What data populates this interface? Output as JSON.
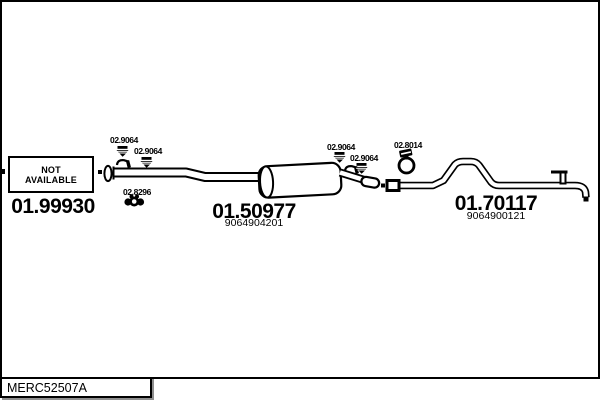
{
  "footer": {
    "reference_code": "MERC52507A"
  },
  "diagram": {
    "not_available": {
      "line1": "NOT",
      "line2": "AVAILABLE"
    },
    "parts": [
      {
        "id": "front-pipe",
        "part_number": "01.99930",
        "oe_number": ""
      },
      {
        "id": "middle-muffler",
        "part_number": "01.50977",
        "oe_number": "9064904201"
      },
      {
        "id": "tail-pipe",
        "part_number": "01.70117",
        "oe_number": "9064900121"
      }
    ],
    "fittings": [
      {
        "id": "clamp-1",
        "code": "02.9064",
        "icon": "pipe-clamp-icon"
      },
      {
        "id": "clamp-2",
        "code": "02.9064",
        "icon": "pipe-clamp-icon"
      },
      {
        "id": "rubber-mount",
        "code": "02.8296",
        "icon": "rubber-mount-icon"
      },
      {
        "id": "clamp-3",
        "code": "02.9064",
        "icon": "pipe-clamp-icon"
      },
      {
        "id": "clamp-4",
        "code": "02.9064",
        "icon": "pipe-clamp-icon"
      },
      {
        "id": "ring-clamp",
        "code": "02.8014",
        "icon": "ring-clamp-icon"
      }
    ],
    "colors": {
      "ink": "#000000",
      "paper": "#ffffff",
      "shadow": "#8f8f8f"
    }
  }
}
